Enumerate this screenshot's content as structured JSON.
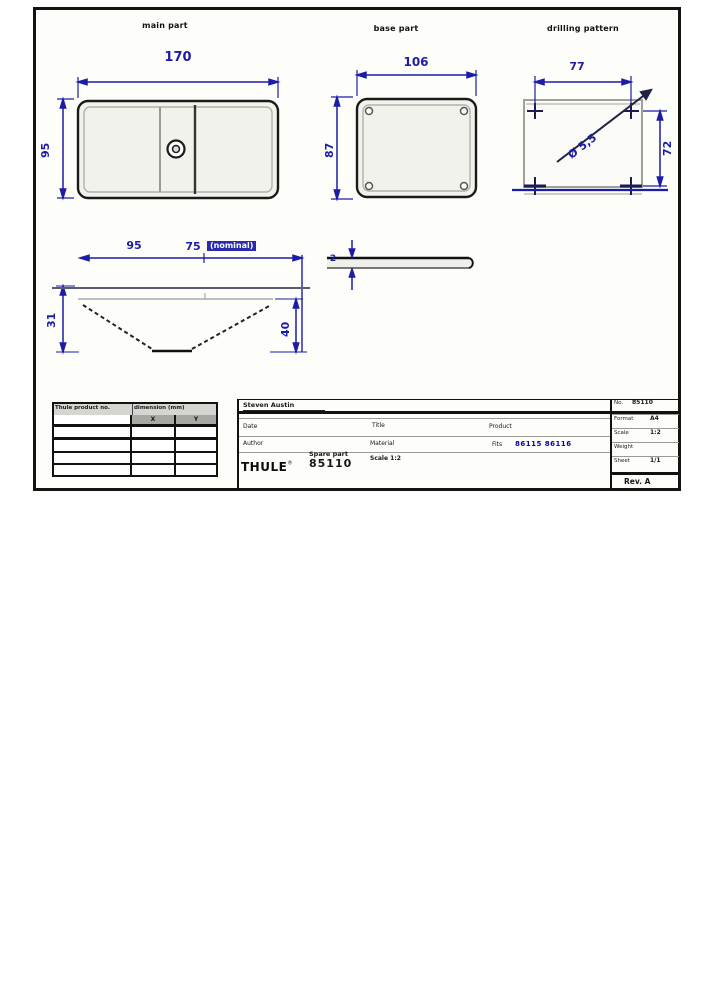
{
  "colors": {
    "dim": "#1c1ca8",
    "line": "#1a1a1a",
    "gray": "#9a9a96",
    "link": "#0000bb"
  },
  "views": {
    "main": {
      "label": "main part",
      "dim_width": "170",
      "dim_height": "95"
    },
    "base": {
      "label": "base part",
      "dim_width": "106",
      "dim_height": "87"
    },
    "drill": {
      "label": "drilling pattern",
      "dim_width": "77",
      "dim_height": "72",
      "dim_hole": "Ø 5,5"
    },
    "side_main": {
      "dim_a": "95",
      "dim_b": "75",
      "dim_b_note": "(nominal)",
      "dim_left": "31",
      "dim_right": "40"
    },
    "side_base": {
      "dim_thickness": "2"
    }
  },
  "parts_table": {
    "header_col1": "Thule product no.",
    "header_col2": "dimension (mm)",
    "sub_x": "X",
    "sub_y": "Y",
    "rows": [
      [
        "",
        "",
        ""
      ],
      [
        "",
        "",
        ""
      ],
      [
        "",
        "",
        ""
      ],
      [
        "",
        "",
        ""
      ]
    ]
  },
  "title_block": {
    "name": "Steven Austin",
    "fields_left": [
      {
        "label": "Date",
        "value": ""
      },
      {
        "label": "Author",
        "value": ""
      }
    ],
    "fields_mid": [
      {
        "label": "Title",
        "value": ""
      },
      {
        "label": "Material",
        "value": ""
      },
      {
        "label": "Scale",
        "value": "1:2"
      }
    ],
    "product_label": "Product",
    "fits_label": "Fits",
    "fits_values": "86115  86116",
    "brand": "THULE",
    "brand_mark": "®",
    "doc_type": "Spare part",
    "doc_number": "85110",
    "right_no_label": "No.",
    "right_no_value": "85110",
    "fields_right": [
      {
        "label": "Format",
        "value": "A4"
      },
      {
        "label": "Scale",
        "value": "1:2"
      },
      {
        "label": "Weight",
        "value": ""
      },
      {
        "label": "Sheet",
        "value": "1/1"
      }
    ],
    "right_bottom": "Rev. A"
  }
}
